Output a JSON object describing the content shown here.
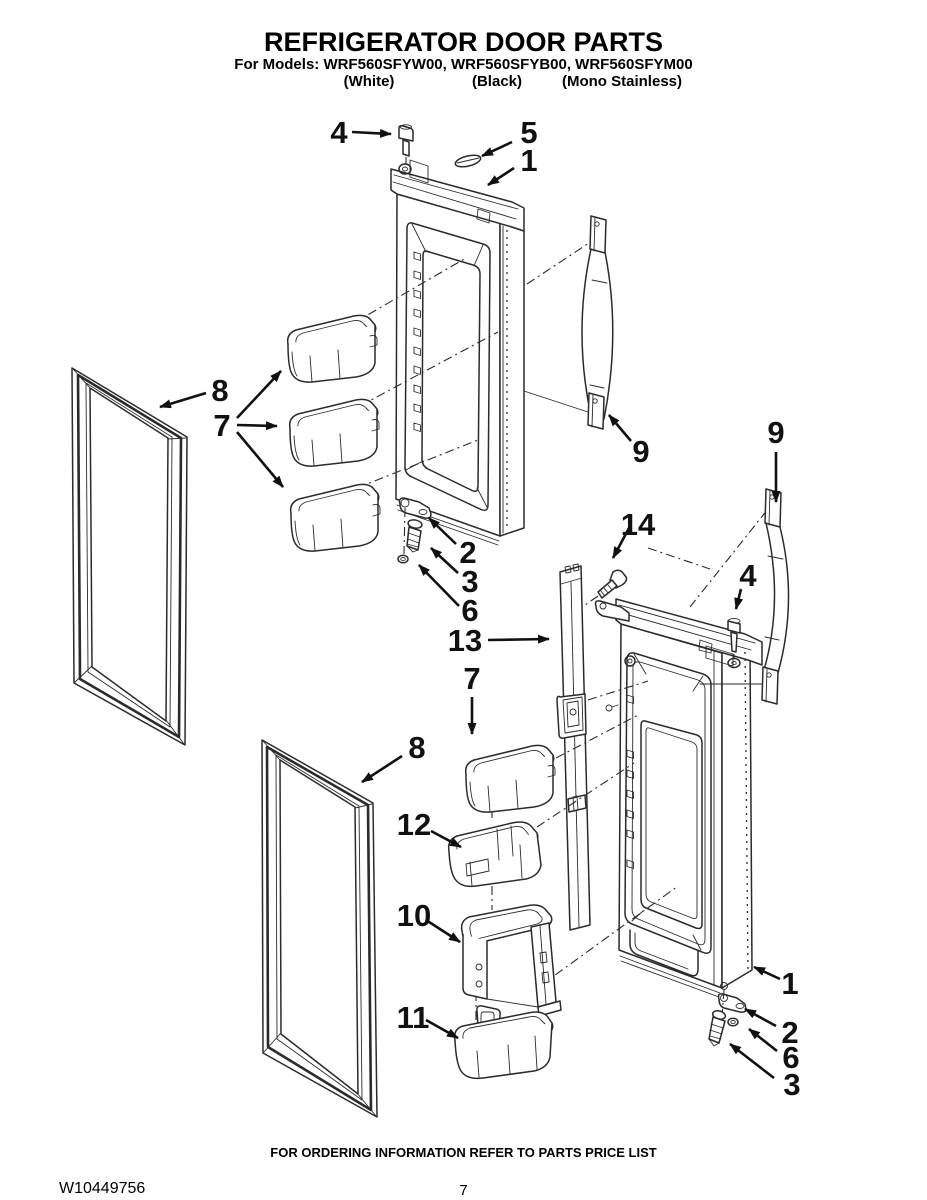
{
  "header": {
    "title": "REFRIGERATOR DOOR PARTS",
    "models_line": "For Models: WRF560SFYW00, WRF560SFYB00, WRF560SFYM00",
    "finishes": [
      "(White)",
      "(Black)",
      "(Mono Stainless)"
    ]
  },
  "diagram": {
    "callouts": [
      {
        "part": "4"
      },
      {
        "part": "5"
      },
      {
        "part": "1"
      },
      {
        "part": "8"
      },
      {
        "part": "7"
      },
      {
        "part": "9"
      },
      {
        "part": "9"
      },
      {
        "part": "14"
      },
      {
        "part": "2"
      },
      {
        "part": "3"
      },
      {
        "part": "6"
      },
      {
        "part": "13"
      },
      {
        "part": "4"
      },
      {
        "part": "7"
      },
      {
        "part": "8"
      },
      {
        "part": "12"
      },
      {
        "part": "10"
      },
      {
        "part": "11"
      },
      {
        "part": "1"
      },
      {
        "part": "2"
      },
      {
        "part": "6"
      },
      {
        "part": "3"
      }
    ]
  },
  "footer": {
    "ordering_note": "FOR ORDERING INFORMATION REFER TO PARTS PRICE LIST",
    "doc_number": "W10449756",
    "page_number": "7"
  }
}
